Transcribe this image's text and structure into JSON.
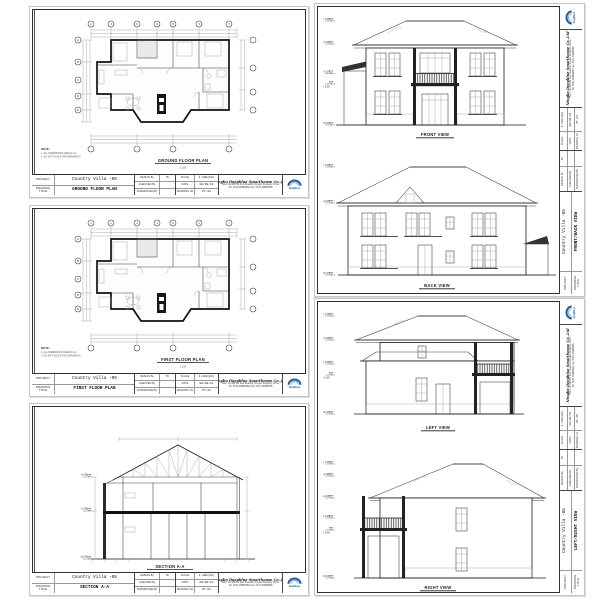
{
  "page": {
    "background": "#ffffff"
  },
  "project": {
    "name": "Country Villa -05"
  },
  "company": {
    "name": "Ningbo Deepblue Smarthouse Co.,Ltd",
    "address": "Add: No.588 Tai Red Road(N) Ningbo Zhejiang China",
    "phone": "Tel: 0574-28886666  Fax: 0574-28886688",
    "logo_text": "DeepBLue",
    "logo_color": "#1c5ca8"
  },
  "tb": {
    "project": "PROJECT",
    "drawing_title": "DRAWING TITLE",
    "design_by": "DESIGN By",
    "checked_by": "CHECKED By",
    "supervised_by": "SUPERVISED By",
    "scale": "SCALE",
    "date": "DATE",
    "drawing_no": "DRAWING No"
  },
  "tbvals": {
    "designer": "Th",
    "checked": "",
    "supervised": "",
    "scale": "1:100(A3)",
    "date": "08/08/11"
  },
  "sheets": {
    "ground": {
      "title": "GROUND FLOOR PLAN",
      "no": "ZY-01",
      "caption": "GROUND FLOOR PLAN",
      "scale_note": "1:100"
    },
    "first": {
      "title": "FIRST FLOOR PLAN",
      "no": "ZY-02",
      "caption": "FIRST FLOOR PLAN",
      "scale_note": "1:100"
    },
    "section": {
      "title": "SECTION A-A",
      "no": "ZY-03",
      "caption": "SECTION A-A",
      "scale_note": "1:100"
    },
    "frontback": {
      "title": "FRONT/BACK VIEW",
      "no": "ZY-04",
      "cap1": "FRONT VIEW",
      "cap2": "BACK VIEW"
    },
    "leftright": {
      "title": "LEFT/RIGHT VIEW",
      "no": "ZY-05",
      "cap1": "LEFT VIEW",
      "cap2": "RIGHT VIEW"
    }
  },
  "plan": {
    "grid_top": [
      "1",
      "2",
      "3",
      "4",
      "5",
      "6",
      "7"
    ],
    "grid_left": [
      "A",
      "B",
      "C",
      "D",
      "E"
    ],
    "note_title": "NOTE:",
    "note1": "1. ALL DIMENSIONS ARE IN mm.",
    "note2": "2. DO NOT SCALE THE DRAWINGS."
  },
  "levels": {
    "front": [
      "+7.38",
      "+6.08",
      "+3.38",
      "+3.08",
      "±0.00"
    ],
    "back": [
      "+7.38",
      "+6.08",
      "±0.00"
    ],
    "left": [
      "+7.38",
      "+6.08",
      "+3.38",
      "+3.08",
      "±0.00"
    ],
    "right": [
      "+7.38",
      "+6.98",
      "+6.08",
      "+3.38",
      "+3.08",
      "±0.00"
    ],
    "section": [
      "+6.08",
      "+3.08",
      "±0.00"
    ]
  }
}
